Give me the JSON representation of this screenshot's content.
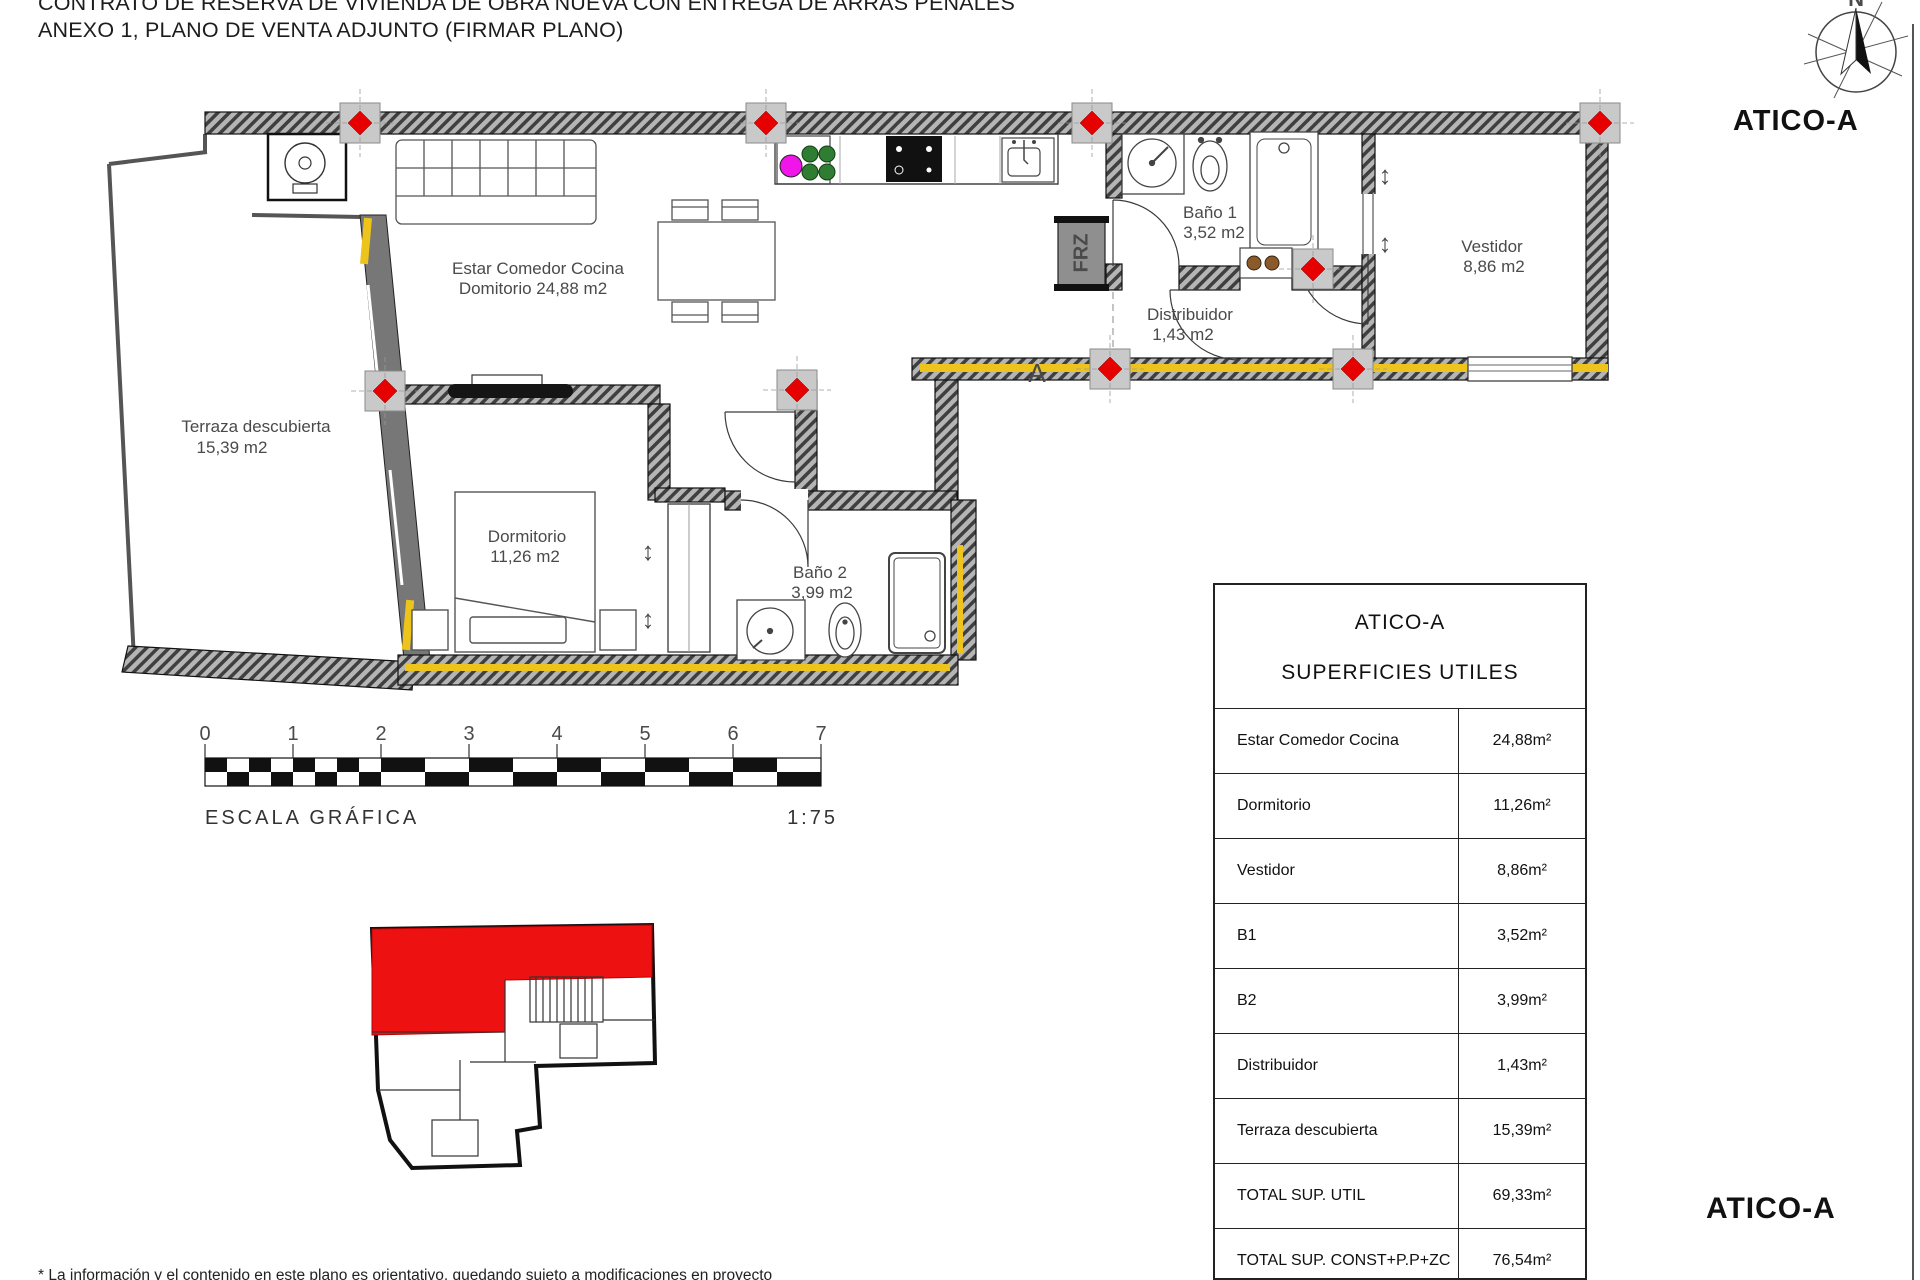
{
  "header": {
    "title_line1": "CONTRATO DE RESERVA DE VIVIENDA DE OBRA NUEVA CON ENTREGA DE ARRAS PENALES",
    "title_line2": "ANEXO 1, PLANO DE VENTA ADJUNTO (FIRMAR PLANO)"
  },
  "compass": {
    "north_label": "N"
  },
  "unit": {
    "name_top": "ATICO-A",
    "name_bottom": "ATICO-A"
  },
  "plan": {
    "labels": {
      "estar_line1": "Estar Comedor Cocina",
      "estar_line2": "Domitorio 24,88 m2",
      "terraza_line1": "Terraza descubierta",
      "terraza_line2": "15,39 m2",
      "dormitorio_line1": "Dormitorio",
      "dormitorio_line2": "11,26 m2",
      "bano2_line1": "Baño 2",
      "bano2_line2": "3,99 m2",
      "bano1_line1": "Baño 1",
      "bano1_line2": "3,52 m2",
      "distribuidor_line1": "Distribuidor",
      "distribuidor_line2": "1,43 m2",
      "vestidor_line1": "Vestidor",
      "vestidor_line2": "8,86 m2",
      "freezer": "FRZ",
      "section_letter": "A"
    }
  },
  "scale_bar": {
    "ticks": [
      "0",
      "1",
      "2",
      "3",
      "4",
      "5",
      "6",
      "7"
    ],
    "caption": "ESCALA GRÁFICA",
    "ratio": "1:75"
  },
  "table": {
    "title": "ATICO-A",
    "subtitle": "SUPERFICIES UTILES",
    "rows": [
      {
        "label": "Estar Comedor Cocina",
        "value": "24,88m²"
      },
      {
        "label": "Dormitorio",
        "value": "11,26m²"
      },
      {
        "label": "Vestidor",
        "value": "8,86m²"
      },
      {
        "label": "B1",
        "value": "3,52m²"
      },
      {
        "label": "B2",
        "value": "3,99m²"
      },
      {
        "label": "Distribuidor",
        "value": "1,43m²"
      },
      {
        "label": "Terraza descubierta",
        "value": "15,39m²"
      },
      {
        "label": "TOTAL SUP. UTIL",
        "value": "69,33m²"
      },
      {
        "label": "TOTAL SUP. CONST+P.P+ZC",
        "value": "76,54m²"
      }
    ]
  },
  "footer": {
    "disclaimer": "* La información y el contenido en este plano es orientativo, quedando sujeto a modificaciones en proyecto"
  },
  "colors": {
    "marker_red": "#e60000",
    "insulation_yellow": "#edc41c",
    "highlight_red": "#ee1111",
    "plant_green": "#2e7d32",
    "plant_magenta": "#f015e8",
    "wall_gray": "#4c4c4c"
  }
}
